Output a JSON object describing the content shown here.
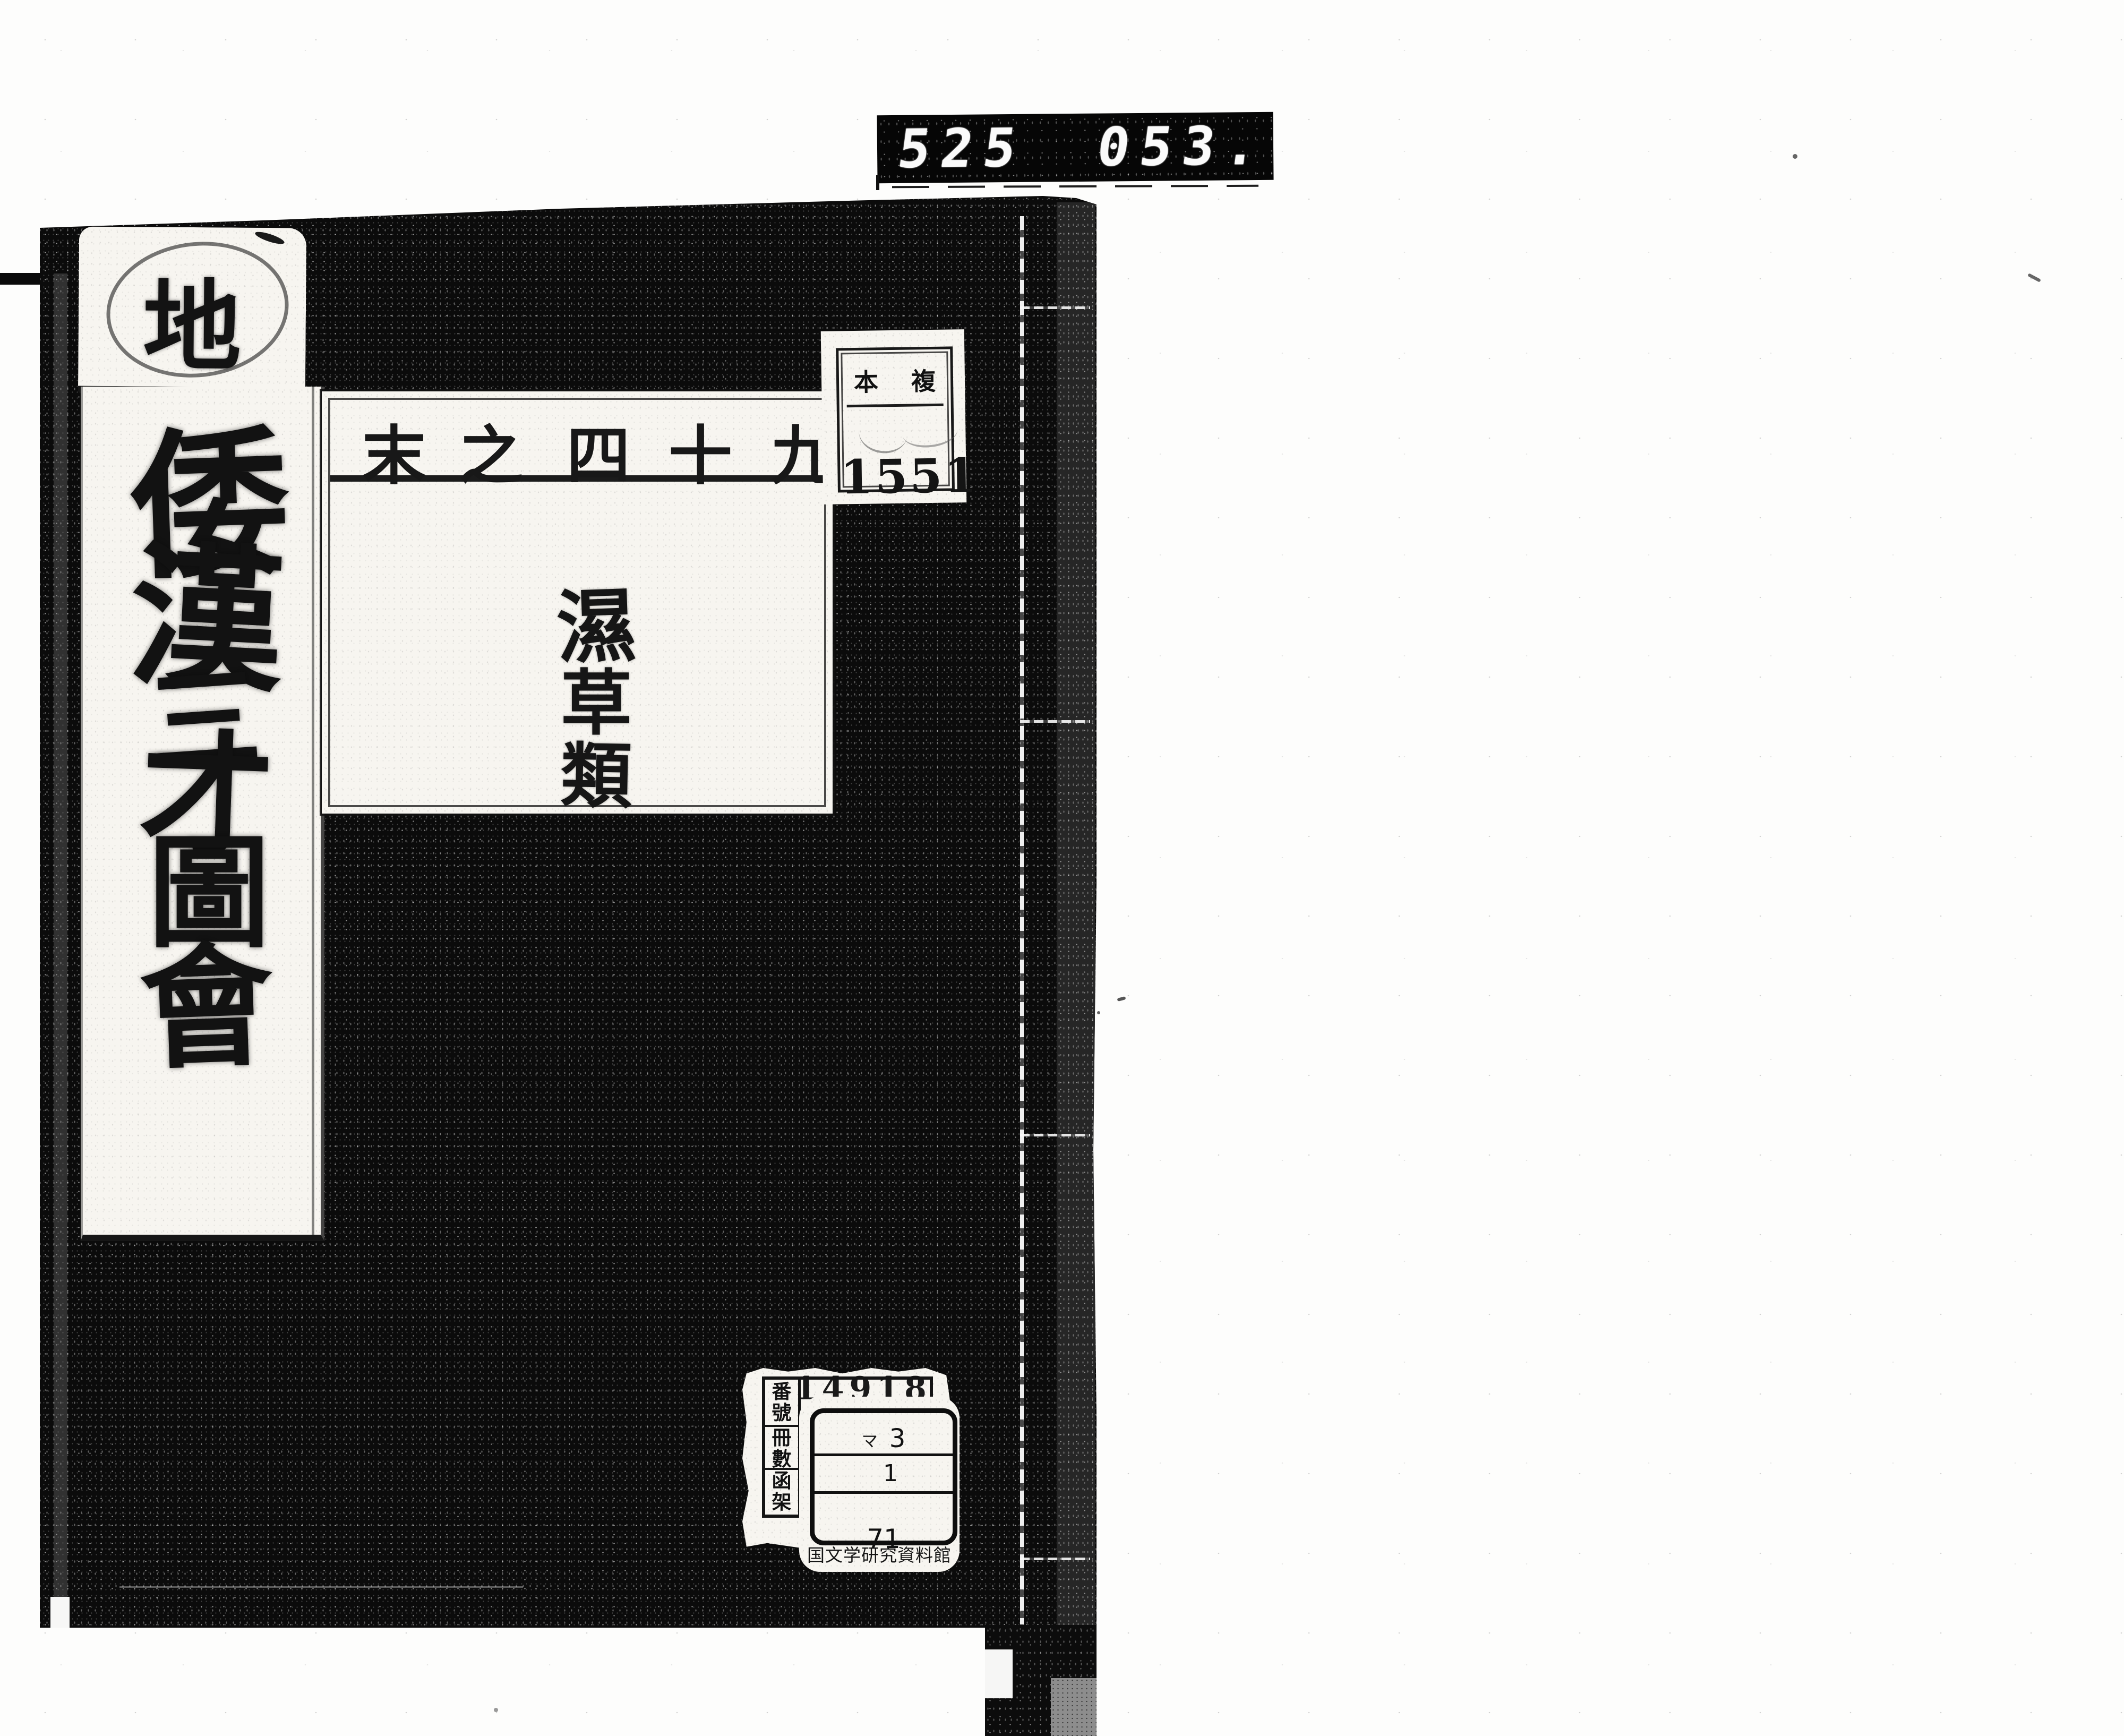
{
  "counter": {
    "group1": "525",
    "group2": "053."
  },
  "cover": {
    "section_label": "地",
    "spine_title": "倭漢三才圖會",
    "spine_chars": [
      "倭",
      "漢",
      "三",
      "才",
      "圖",
      "會"
    ],
    "slip": {
      "volume_display": "末之四十九",
      "volume_chars": [
        "末",
        "之",
        "四",
        "十",
        "九"
      ],
      "category": "濕草類",
      "category_chars": [
        "濕",
        "草",
        "類"
      ]
    },
    "shelf_label": {
      "left_char": "本",
      "right_char": "複",
      "number": "1551"
    },
    "register_label": {
      "headers": [
        [
          "番",
          "號"
        ],
        [
          "冊",
          "數"
        ],
        [
          "函",
          "架"
        ]
      ],
      "number": "14918"
    },
    "call_label": {
      "row1_kana": "マ",
      "row1_num": "3",
      "row2_num": "1",
      "row3_num": "71",
      "institution": "国文学研究資料館"
    }
  }
}
